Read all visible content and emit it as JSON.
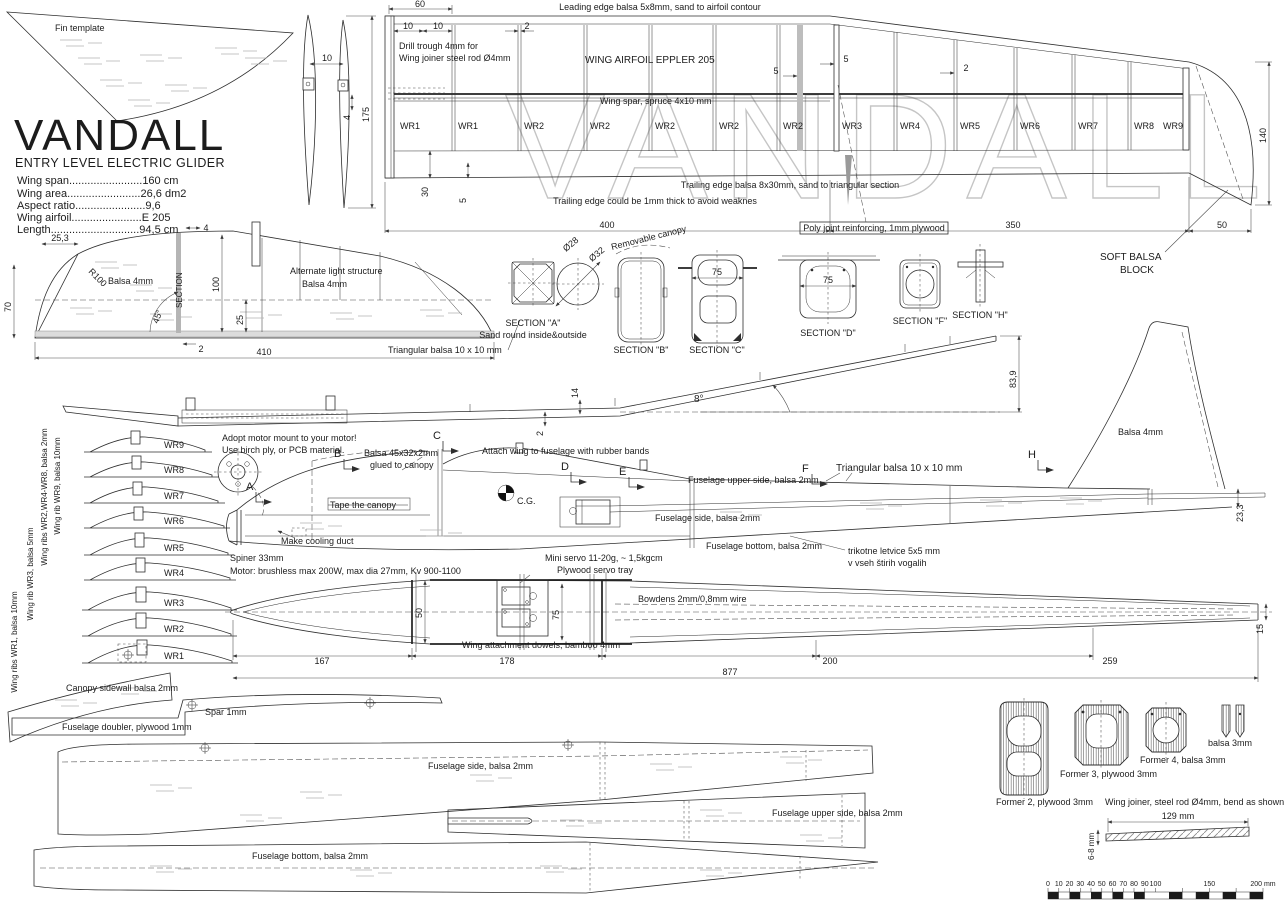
{
  "meta": {
    "watermark": "VANDALL"
  },
  "title_block": {
    "title": "VANDALL",
    "subtitle": "ENTRY LEVEL ELECTRIC GLIDER",
    "spec1": "Wing span........................160 cm",
    "spec2": "Wing area........................26,6 dm2",
    "spec3": "Aspect ratio.......................9,6",
    "spec4": "Wing airfoil.......................E 205",
    "spec5": "Length.............................94,5 cm"
  },
  "fin": {
    "label": "Fin template",
    "dim10": "10",
    "dim4": "4",
    "dim175": "175"
  },
  "wing_plan": {
    "leading_edge": "Leading edge balsa 5x8mm, sand to airfoil contour",
    "airfoil": "WING AIRFOIL EPPLER 205",
    "spar": "Wing spar, spruce 4x10 mm",
    "drill1": "Drill trough 4mm for",
    "drill2": "Wing joiner steel rod Ø4mm",
    "trailing1": "Trailing edge balsa 8x30mm, sand to triangular section",
    "trailing2": "Trailing edge could be 1mm thick to avoid weaknes",
    "poly_joint": "Poly joint reinforcing, 1mm plywood",
    "soft_balsa1": "SOFT BALSA",
    "soft_balsa2": "BLOCK",
    "dim60": "60",
    "dim10a": "10",
    "dim10b": "10",
    "dim2a": "2",
    "dim5a": "5",
    "dim5b": "5",
    "dim2b": "2",
    "dim30": "30",
    "dim5c": "5",
    "dim400": "400",
    "dim350": "350",
    "dim50": "50",
    "dim140": "140",
    "ribs": [
      "WR1",
      "WR1",
      "WR2",
      "WR2",
      "WR2",
      "WR2",
      "WR2",
      "WR3",
      "WR4",
      "WR5",
      "WR6",
      "WR7",
      "WR8",
      "WR9"
    ]
  },
  "stab": {
    "dim253": "25,3",
    "dim70": "70",
    "r100": "R100",
    "balsa": "Balsa 4mm",
    "section_label": "SECTION",
    "dim4": "4",
    "dim100": "100",
    "dim25": "25",
    "dim45": "45°",
    "dim2": "2",
    "dim410": "410",
    "alt1": "Alternate light structure",
    "alt2": "Balsa 4mm",
    "triangular": "Triangular balsa 10 x 10 mm"
  },
  "sections": {
    "a_label": "SECTION \"A\"",
    "a_note": "Sand round inside&outside",
    "d28": "Ø28",
    "d32": "Ø32",
    "b_label": "SECTION \"B\"",
    "canopy": "Removable canopy",
    "c_label": "SECTION \"C\"",
    "c_dim": "75",
    "d_label": "SECTION \"D\"",
    "d_dim": "75",
    "f_label": "SECTION \"F\"",
    "h_label": "SECTION \"H\""
  },
  "front_view": {
    "dim2": "2",
    "dim14": "14",
    "dim8": "8°",
    "dim839": "83,9"
  },
  "rib_stack": {
    "ribs": [
      "WR9",
      "WR8",
      "WR7",
      "WR6",
      "WR5",
      "WR4",
      "WR3",
      "WR2",
      "WR1"
    ],
    "note_wr2": "Wing ribs WR2,WR4-WR8, balsa 2mm",
    "note_wr9": "Wing rib WR9, balsa 10mm",
    "note_wr3": "Wing rib WR3, balsa 5mm",
    "note_wr1": "Wing ribs WR1, balsa 10mm"
  },
  "side_view": {
    "motor_note1": "Adopt motor mount to your motor!",
    "motor_note2": "Use birch ply, or PCB material.",
    "canopy_balsa1": "Balsa 45x32x2mm",
    "canopy_balsa2": "glued to canopy",
    "attach": "Attach wing to fuselage with rubber bands",
    "tape": "Tape the canopy",
    "duct": "Make cooling duct",
    "cg": "C.G.",
    "spinner": "Spiner 33mm",
    "motor_spec": "Motor: brushless max 200W, max dia 27mm, Kv 900-1100",
    "servo": "Mini servo 11-20g, ~ 1,5kgcm",
    "tray": "Plywood servo tray",
    "upper": "Fuselage upper side, balsa 2mm",
    "side": "Fuselage side, balsa 2mm",
    "bottom": "Fuselage bottom, balsa 2mm",
    "triangular": "Triangular balsa 10 x 10 mm",
    "slo1": "trikotne letvice 5x5 mm",
    "slo2": "v vseh štirih vogalih",
    "fin_balsa": "Balsa 4mm",
    "dim233": "23,3",
    "cuts": {
      "a": "A",
      "b": "B",
      "c": "C",
      "d": "D",
      "e": "E",
      "f": "F",
      "h": "H"
    }
  },
  "top_view": {
    "bowden": "Bowdens 2mm/0,8mm wire",
    "dowels": "Wing attachment dowels, bamboo 4mm",
    "dim50": "50",
    "dim75": "75",
    "dim167": "167",
    "dim178": "178",
    "dim200": "200",
    "dim259": "259",
    "dim877": "877",
    "dim15": "15"
  },
  "parts": {
    "canopy": "Canopy sidewall balsa 2mm",
    "spar": "Spar 1mm",
    "doubler": "Fuselage doubler, plywood 1mm",
    "side": "Fuselage side, balsa 2mm",
    "upper": "Fuselage upper side, balsa 2mm",
    "bottom": "Fuselage bottom, balsa 2mm"
  },
  "formers": {
    "f2": "Former 2, plywood 3mm",
    "f3": "Former 3, plywood 3mm",
    "f4": "Former 4, balsa 3mm",
    "tip": "balsa 3mm",
    "joiner": "Wing joiner, steel rod Ø4mm, bend as shown",
    "dim129": "129 mm",
    "dim68": "6-8 mm"
  },
  "ruler": {
    "ticks": [
      "0",
      "10",
      "20",
      "30",
      "40",
      "50",
      "60",
      "70",
      "80",
      "90",
      "100",
      "150",
      "200 mm"
    ]
  }
}
